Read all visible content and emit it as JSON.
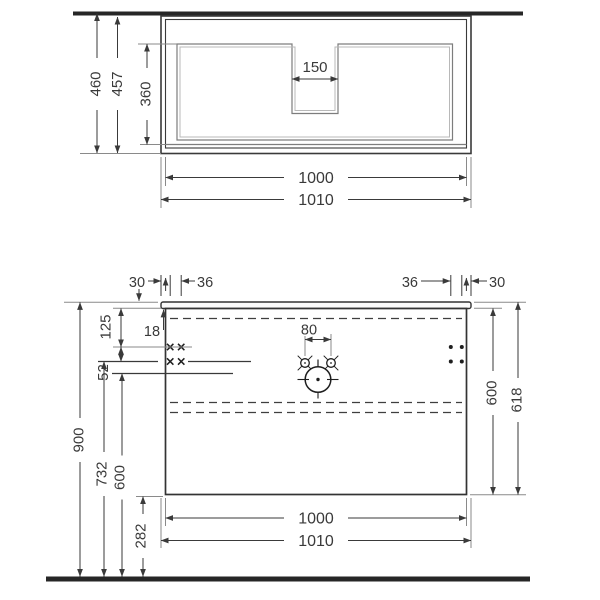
{
  "drawing_title": "vanity-unit-technical-drawing",
  "top_view": {
    "depth_overall": "460",
    "depth_worktop": "457",
    "basin_recess_depth": "360",
    "notch_width": "150",
    "carcass_width": "1000",
    "worktop_width": "1010"
  },
  "front_view": {
    "offset_left": "30",
    "pitch_left": "36",
    "pitch_right": "36",
    "offset_right": "30",
    "top_to_upper_holes": "125",
    "worktop_thickness": "18",
    "hole_rows_gap": "52",
    "tap_holes_pitch": "80",
    "carcass_height": "600",
    "overall_height": "618",
    "worktop_level": "900",
    "upper_holes_level": "732",
    "outlet_level": "600",
    "underpass_clearance": "282",
    "carcass_width": "1000",
    "worktop_width": "1010"
  }
}
